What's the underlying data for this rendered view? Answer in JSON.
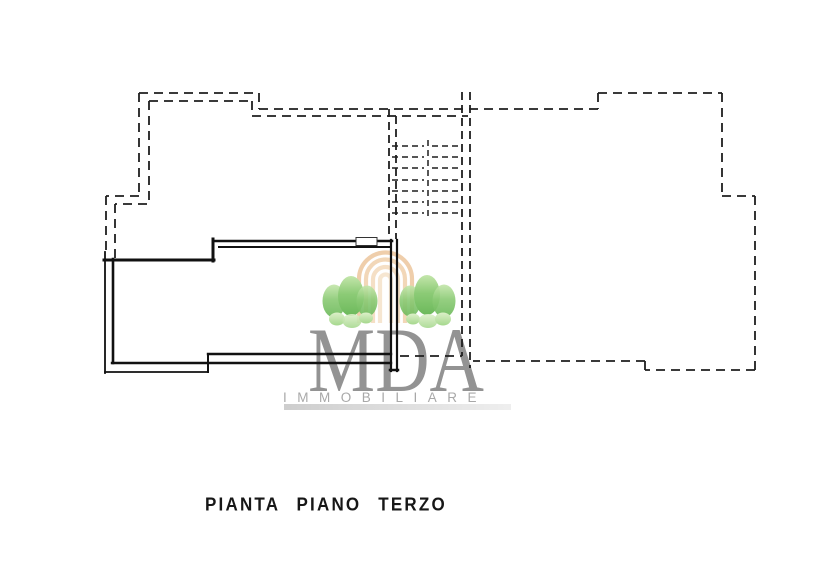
{
  "page": {
    "background_color": "#ffffff",
    "kind": "scanned floor plan drawing"
  },
  "plan_title": {
    "text": "PIANTA PIANO TERZO"
  },
  "watermark": {
    "brand": "MDA",
    "subtitle": "IMMOBILIARE",
    "brand_color": "#8a8a8a",
    "subtitle_color": "#a4a4a4",
    "underline_bar_color": "#bdbdbd",
    "tree_green_dark": "#6cb95b",
    "tree_green_mid": "#8ccb76",
    "tree_green_light": "#c8e8b4",
    "arch_peach": "#eec9a2"
  },
  "drawing": {
    "line_color": "#1f1f1f",
    "solid_unit_wall_color": "#111111"
  }
}
